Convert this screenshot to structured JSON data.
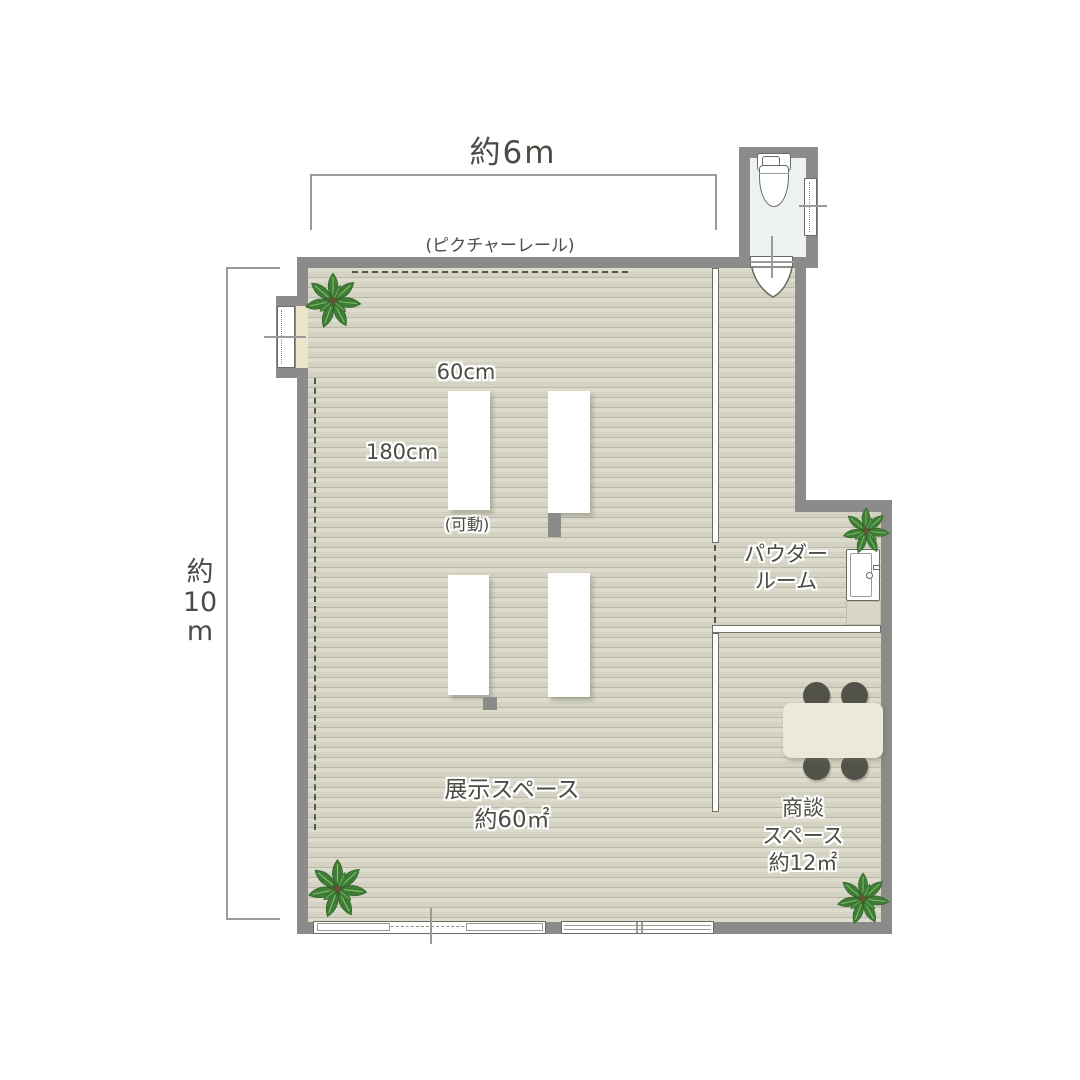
{
  "floor_plan": {
    "dimensions": {
      "width_label": "約6m",
      "height_label_lines": [
        "約",
        "10",
        "m"
      ]
    },
    "labels": {
      "picture_rail": "(ピクチャーレール)",
      "fixture_width": "60cm",
      "fixture_length": "180cm",
      "movable": "(可動)",
      "powder_room_lines": [
        "パウダー",
        "ルーム"
      ],
      "exhibition_lines": [
        "展示スペース",
        "約60㎡"
      ],
      "meeting_lines": [
        "商談",
        "スペース",
        "約12㎡"
      ]
    },
    "colors": {
      "wall": "#8b8b89",
      "floor_base": "#dcdbcc",
      "floor_stripe": "#b9b9aa",
      "toilet_floor": "#ecf2f1",
      "display_table": "#ffffff",
      "meeting_table": "#ece8da",
      "chair": "#53524a",
      "plant_leaf_light": "#5d9c4b",
      "plant_leaf_dark": "#3f7d36",
      "plant_pot": "#6e4f38",
      "text": "#4c4b45",
      "dimension_line": "#9a9a96"
    }
  }
}
